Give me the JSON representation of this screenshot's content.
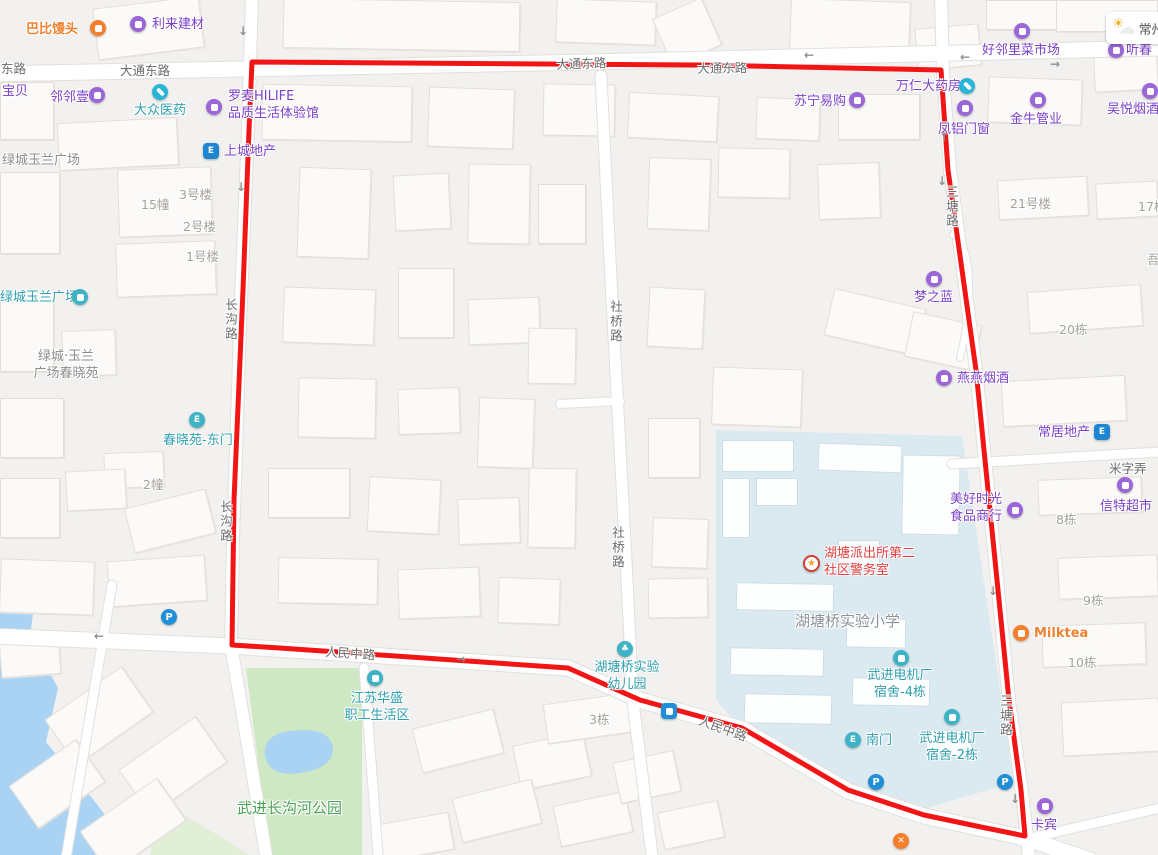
{
  "colors": {
    "boundary": "#f21515",
    "poi_purple": "#7b40c8",
    "poi_teal": "#2d9fae",
    "poi_orange": "#ef8230",
    "poi_red": "#e23d3d",
    "park_green": "#cfe8c4",
    "water_blue": "#aad2f2",
    "campus_blue": "#dbe9f1"
  },
  "weather": {
    "city": "常州"
  },
  "pois": [
    {
      "label": "巴比馒头",
      "style": "orange",
      "tx": 26,
      "ty": 22,
      "icon": {
        "t": "food",
        "x": 90,
        "y": 20
      }
    },
    {
      "label": "利来建材",
      "style": "purple",
      "tx": 152,
      "ty": 17,
      "icon": {
        "t": "shop",
        "x": 130,
        "y": 16
      }
    },
    {
      "label": "宝贝",
      "style": "purple",
      "tx": 2,
      "ty": 84
    },
    {
      "label": "邻邻壹",
      "style": "purple",
      "tx": 50,
      "ty": 90,
      "icon": {
        "t": "shop",
        "x": 89,
        "y": 87
      }
    },
    {
      "label": "大众医药",
      "style": "teal",
      "tx": 134,
      "ty": 103,
      "icon": {
        "t": "pill",
        "x": 152,
        "y": 84
      }
    },
    {
      "label": "罗麦HILIFE\n品质生活体验馆",
      "style": "purple",
      "tx": 228,
      "ty": 89,
      "icon": {
        "t": "shop",
        "x": 206,
        "y": 99
      }
    },
    {
      "label": "苏宁易购",
      "style": "purple",
      "tx": 794,
      "ty": 94,
      "icon": {
        "t": "shop",
        "x": 849,
        "y": 92
      }
    },
    {
      "label": "万仁大药房",
      "style": "purple",
      "tx": 896,
      "ty": 79,
      "icon": {
        "t": "pill",
        "x": 959,
        "y": 78
      }
    },
    {
      "label": "凤铝门窗",
      "style": "purple",
      "tx": 938,
      "ty": 122,
      "icon": {
        "t": "shop",
        "x": 957,
        "y": 100
      }
    },
    {
      "label": "金牛管业",
      "style": "purple",
      "tx": 1010,
      "ty": 112,
      "icon": {
        "t": "shop",
        "x": 1030,
        "y": 92
      }
    },
    {
      "label": "好邻里菜市场",
      "style": "purple",
      "tx": 982,
      "ty": 43,
      "icon": {
        "t": "shop",
        "x": 1014,
        "y": 23
      }
    },
    {
      "label": "听春",
      "style": "purple",
      "tx": 1126,
      "ty": 43,
      "icon": {
        "t": "shop",
        "x": 1108,
        "y": 42
      }
    },
    {
      "label": "吴悦烟酒",
      "style": "purple",
      "tx": 1107,
      "ty": 102,
      "icon": {
        "t": "shop",
        "x": 1142,
        "y": 83
      }
    },
    {
      "label": "上城地产",
      "style": "purple",
      "tx": 224,
      "ty": 144,
      "icon": {
        "t": "estate",
        "x": 203,
        "y": 143
      }
    },
    {
      "label": "绿城玉兰广场",
      "style": "gray2",
      "tx": 2,
      "ty": 153
    },
    {
      "label": "绿城玉兰广场",
      "style": "teal",
      "tx": 0,
      "ty": 290,
      "icon": {
        "t": "bldg",
        "x": 72,
        "y": 289
      }
    },
    {
      "label": "绿城·玉兰\n广场春晓苑",
      "style": "gray2",
      "align": "center",
      "w": 96,
      "tx": 18,
      "ty": 349
    },
    {
      "label": "春晓苑-东门",
      "style": "teal",
      "tx": 163,
      "ty": 433,
      "icon": {
        "t": "gate",
        "x": 189,
        "y": 412
      }
    },
    {
      "label": "2幢",
      "style": "gray1",
      "tx": 143,
      "ty": 477
    },
    {
      "label": "15幢",
      "style": "gray1",
      "tx": 141,
      "ty": 197
    },
    {
      "label": "3号楼",
      "style": "gray1",
      "tx": 179,
      "ty": 187
    },
    {
      "label": "2号楼",
      "style": "gray1",
      "tx": 183,
      "ty": 219
    },
    {
      "label": "1号楼",
      "style": "gray1",
      "tx": 186,
      "ty": 249
    },
    {
      "label": "21号楼",
      "style": "gray1",
      "tx": 1010,
      "ty": 196
    },
    {
      "label": "17栋",
      "style": "gray1",
      "tx": 1138,
      "ty": 199
    },
    {
      "label": "吾",
      "style": "gray1",
      "tx": 1147,
      "ty": 252
    },
    {
      "label": "梦之蓝",
      "style": "purple",
      "tx": 914,
      "ty": 290,
      "icon": {
        "t": "shop",
        "x": 926,
        "y": 271
      }
    },
    {
      "label": "20栋",
      "style": "gray1",
      "tx": 1059,
      "ty": 322
    },
    {
      "label": "燕燕烟酒",
      "style": "purple",
      "tx": 957,
      "ty": 371,
      "icon": {
        "t": "shop",
        "x": 936,
        "y": 370
      }
    },
    {
      "label": "常居地产",
      "style": "purple",
      "tx": 1038,
      "ty": 425,
      "icon": {
        "t": "estate",
        "x": 1094,
        "y": 424
      }
    },
    {
      "label": "美好时光\n食品商行",
      "style": "purple",
      "tx": 950,
      "ty": 492,
      "icon": {
        "t": "shop",
        "x": 1007,
        "y": 502
      }
    },
    {
      "label": "信特超市",
      "style": "purple",
      "tx": 1100,
      "ty": 499,
      "icon": {
        "t": "shop",
        "x": 1117,
        "y": 477
      }
    },
    {
      "label": "8栋",
      "style": "gray1",
      "tx": 1056,
      "ty": 512
    },
    {
      "label": "9栋",
      "style": "gray1",
      "tx": 1083,
      "ty": 593
    },
    {
      "label": "Milktea",
      "style": "orange",
      "tx": 1034,
      "ty": 626,
      "icon": {
        "t": "tea",
        "x": 1013,
        "y": 625
      }
    },
    {
      "label": "10栋",
      "style": "gray1",
      "tx": 1068,
      "ty": 655
    },
    {
      "label": "湖塘派出所第二\n社区警务室",
      "style": "red",
      "tx": 824,
      "ty": 546,
      "icon": {
        "t": "police",
        "x": 803,
        "y": 555
      }
    },
    {
      "label": "湖塘桥实验小学",
      "style": "school",
      "tx": 795,
      "ty": 612
    },
    {
      "label": "武进电机厂\n宿舍-4栋",
      "style": "teal",
      "align": "center",
      "w": 72,
      "tx": 864,
      "ty": 668,
      "icon": {
        "t": "bldg",
        "x": 893,
        "y": 650
      }
    },
    {
      "label": "南门",
      "style": "teal",
      "tx": 866,
      "ty": 733,
      "icon": {
        "t": "gate",
        "x": 845,
        "y": 732
      }
    },
    {
      "label": "武进电机厂\n宿舍-2栋",
      "style": "teal",
      "align": "center",
      "w": 72,
      "tx": 916,
      "ty": 731,
      "icon": {
        "t": "bldg",
        "x": 944,
        "y": 709
      }
    },
    {
      "label": "卡宾",
      "style": "purple",
      "tx": 1031,
      "ty": 818,
      "icon": {
        "t": "shop",
        "x": 1037,
        "y": 798
      }
    },
    {
      "label": "江苏华盛\n职工生活区",
      "style": "teal",
      "align": "center",
      "w": 78,
      "tx": 338,
      "ty": 691,
      "icon": {
        "t": "bldg",
        "x": 367,
        "y": 670
      }
    },
    {
      "label": "湖塘桥实验\n幼儿园",
      "style": "teal",
      "align": "center",
      "w": 78,
      "tx": 588,
      "ty": 660,
      "icon": {
        "t": "tree",
        "x": 617,
        "y": 641
      }
    },
    {
      "label": "3栋",
      "style": "gray1",
      "tx": 589,
      "ty": 712
    },
    {
      "label": "武进长沟河公园",
      "style": "green",
      "tx": 237,
      "ty": 799
    },
    {
      "icon": {
        "t": "parking",
        "x": 161,
        "y": 609
      }
    },
    {
      "icon": {
        "t": "parking",
        "x": 868,
        "y": 774
      }
    },
    {
      "icon": {
        "t": "parking",
        "x": 997,
        "y": 774
      }
    },
    {
      "icon": {
        "t": "bus",
        "x": 661,
        "y": 703
      }
    },
    {
      "icon": {
        "t": "rest",
        "x": 893,
        "y": 833
      }
    }
  ],
  "road_labels": [
    {
      "label": "东路",
      "x": 1,
      "y": 58
    },
    {
      "label": "大通东路",
      "x": 120,
      "y": 60
    },
    {
      "label": "大通东路",
      "x": 556,
      "y": 54,
      "rot": -2
    },
    {
      "label": "大通东路",
      "x": 697,
      "y": 58,
      "rot": -1
    },
    {
      "label": "长沟路",
      "x": 221,
      "y": 298,
      "vert": true
    },
    {
      "label": "长沟路",
      "x": 216,
      "y": 500,
      "vert": true
    },
    {
      "label": "社桥路",
      "x": 606,
      "y": 300,
      "vert": true
    },
    {
      "label": "社桥路",
      "x": 608,
      "y": 526,
      "vert": true
    },
    {
      "label": "三塘路",
      "x": 942,
      "y": 185,
      "vert": true
    },
    {
      "label": "三塘路",
      "x": 996,
      "y": 694,
      "vert": true
    },
    {
      "label": "人民中路",
      "x": 326,
      "y": 641,
      "rot": 4
    },
    {
      "label": "人民中路",
      "x": 703,
      "y": 710,
      "rot": 20
    },
    {
      "label": "米字弄",
      "x": 1109,
      "y": 458
    }
  ],
  "arrows": [
    {
      "x": 238,
      "y": 24,
      "g": "↓"
    },
    {
      "x": 236,
      "y": 180,
      "g": "↓"
    },
    {
      "x": 939,
      "y": 130,
      "g": "↑"
    },
    {
      "x": 937,
      "y": 174,
      "g": "↓"
    },
    {
      "x": 804,
      "y": 48,
      "g": "←"
    },
    {
      "x": 960,
      "y": 50,
      "g": "←"
    },
    {
      "x": 1050,
      "y": 57,
      "g": "→"
    },
    {
      "x": 456,
      "y": 652,
      "g": "→"
    },
    {
      "x": 94,
      "y": 629,
      "g": "←"
    },
    {
      "x": 988,
      "y": 584,
      "g": "↓"
    },
    {
      "x": 1010,
      "y": 792,
      "g": "↓"
    }
  ]
}
